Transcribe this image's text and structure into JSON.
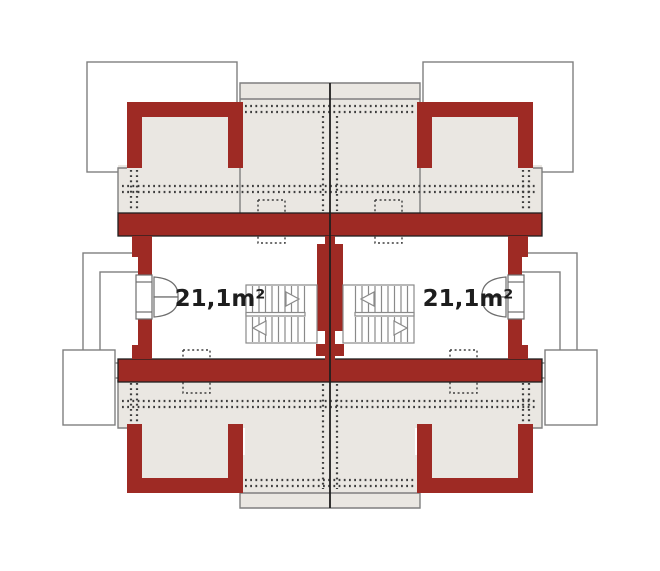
{
  "plan": {
    "kind": "attic-floor-plan",
    "description": "Mirrored attic floor plan of a semi-detached house, two identical units",
    "rooms": [
      {
        "unit": "left",
        "area_label": "21,1m²"
      },
      {
        "unit": "right",
        "area_label": "21,1m²"
      }
    ],
    "colors": {
      "wall": "#9e2a24",
      "floor": "#eae7e2",
      "roof_outline": "#7f7f7f",
      "structure_line": "#1f1f1f",
      "marking_dots": "#3d3d3d",
      "stair_line": "#8a8a8a",
      "window_line": "#6e6e6e",
      "background": "#ffffff"
    }
  }
}
